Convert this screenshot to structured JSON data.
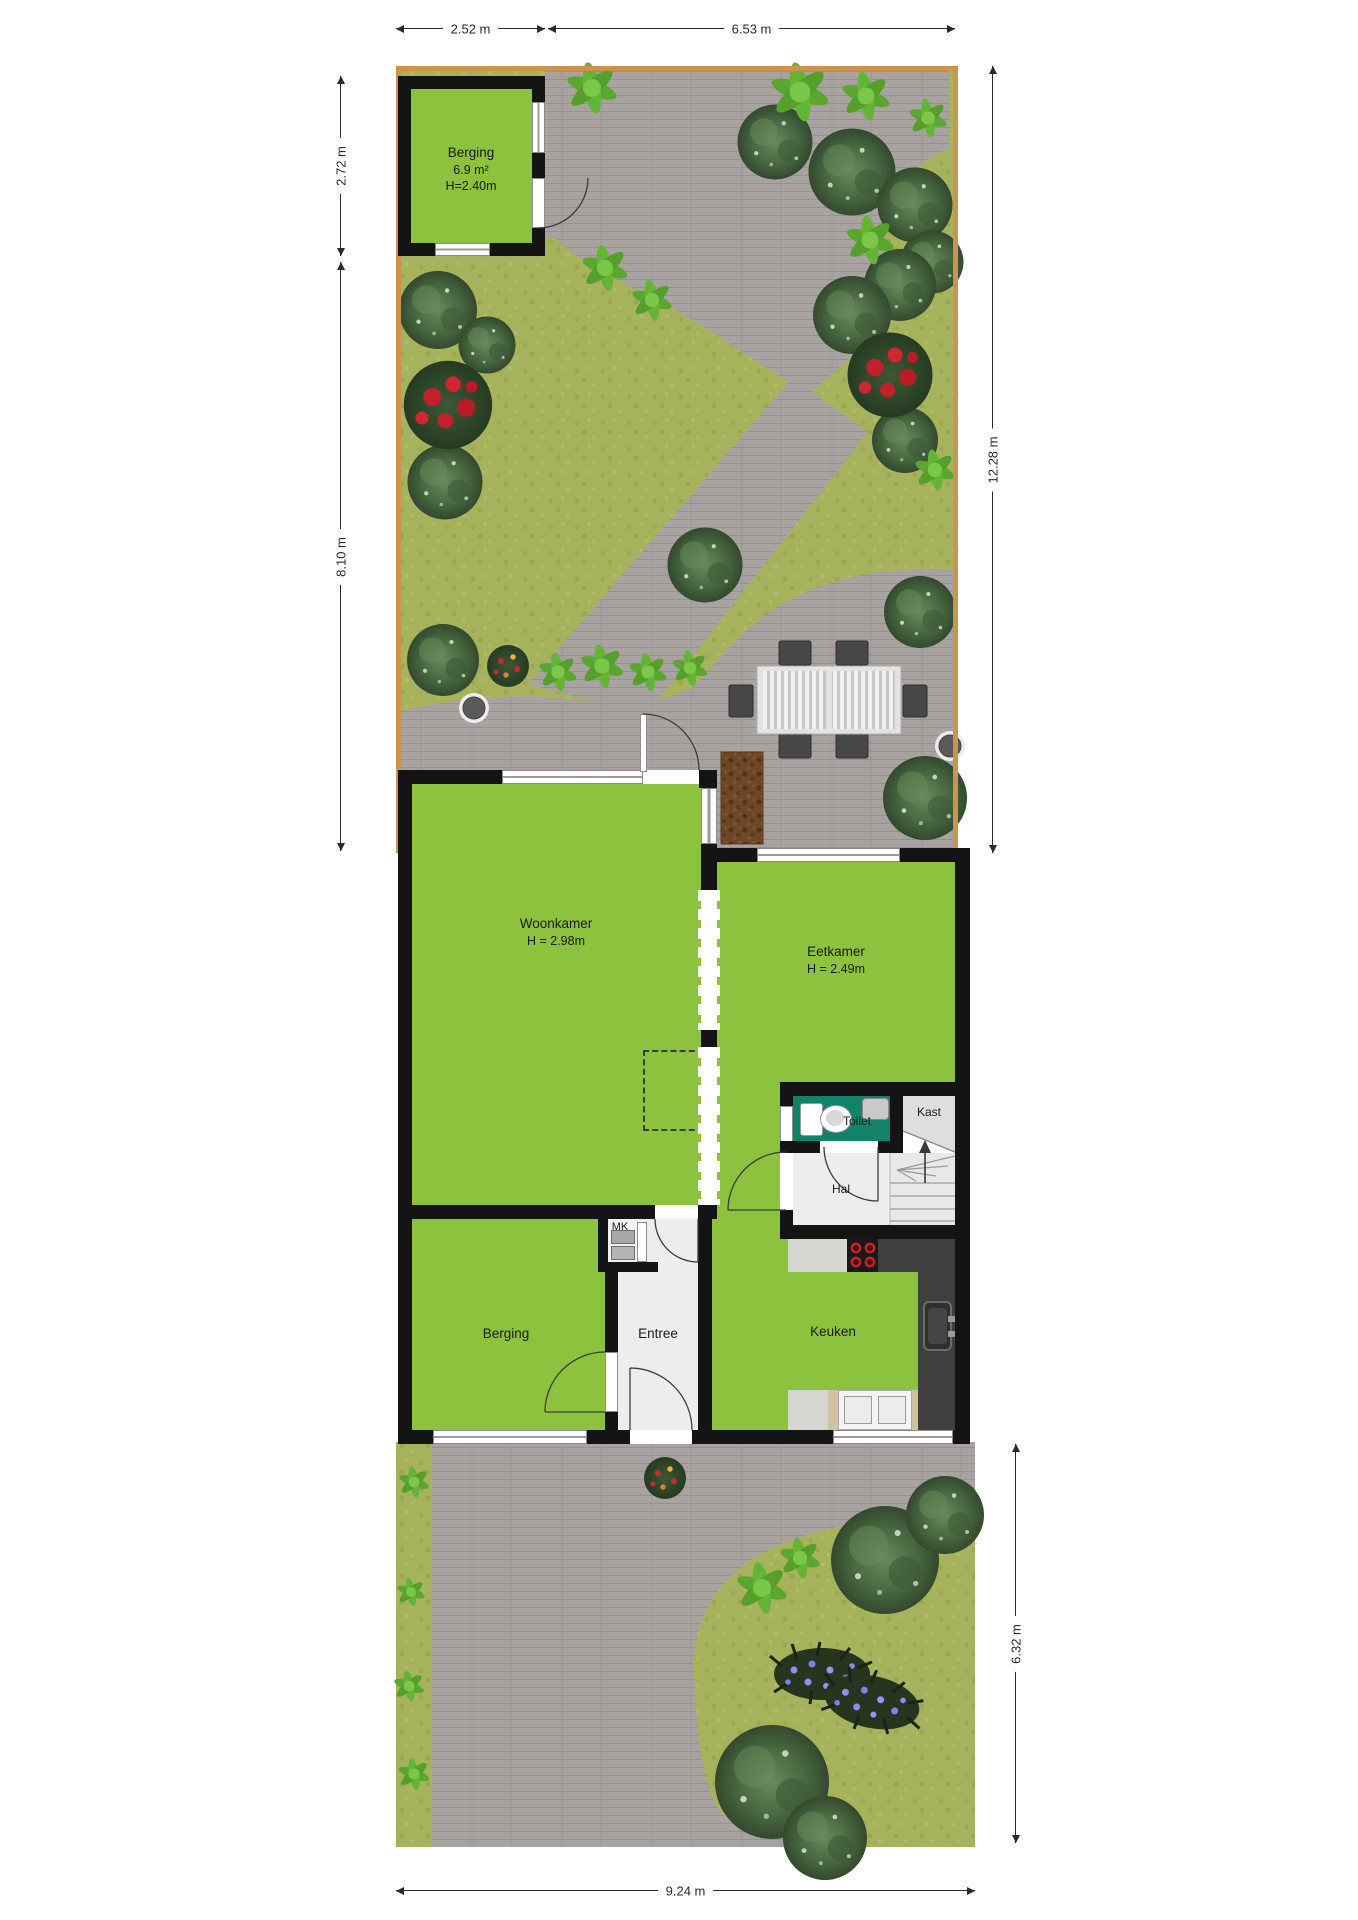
{
  "dimensions": {
    "top_left": "2.52 m",
    "top_right": "6.53 m",
    "left_upper": "2.72 m",
    "left_lower": "8.10 m",
    "right_garden": "12.28 m",
    "right_front": "6.32 m",
    "bottom": "9.24 m"
  },
  "rooms": {
    "shed": {
      "name": "Berging",
      "area": "6.9 m²",
      "height": "H=2.40m"
    },
    "woonkamer": {
      "name": "Woonkamer",
      "height": "H = 2.98m"
    },
    "eetkamer": {
      "name": "Eetkamer",
      "height": "H = 2.49m"
    },
    "toilet": {
      "name": "Toilet"
    },
    "kast": {
      "name": "Kast"
    },
    "hal": {
      "name": "Hal"
    },
    "mk": {
      "name": "MK"
    },
    "berging": {
      "name": "Berging"
    },
    "entree": {
      "name": "Entree"
    },
    "keuken": {
      "name": "Keuken"
    }
  },
  "colors": {
    "room_floor": "#8cc23d",
    "wall": "#141414",
    "grass": "#a6b25c",
    "pavement": "#a8a3a0",
    "toilet_floor": "#12826a",
    "garden_border": "#c9944d",
    "counter_dark": "#3f3f3e",
    "mulch": "#6e4726",
    "hall_floor": "#ededed"
  }
}
